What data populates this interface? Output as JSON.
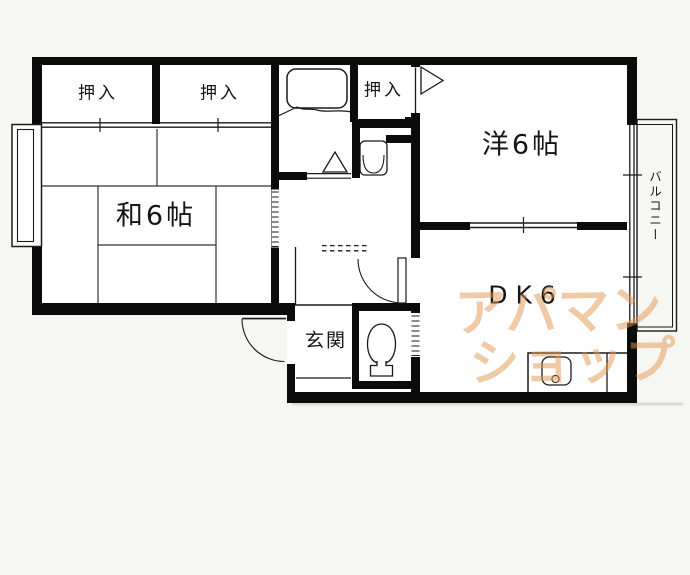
{
  "plan": {
    "title": "2DK apartment floor plan",
    "rooms": {
      "oshiire1": "押入",
      "oshiire2": "押入",
      "oshiire3": "押入",
      "washitsu": "和6帖",
      "youshitsu": "洋6帖",
      "dk": "DK6",
      "genkan": "玄関",
      "balcony": "バルコニー"
    },
    "fixtures": {
      "bathtub": "bathtub-icon",
      "washbasin": "washbasin-icon",
      "toilet": "toilet-icon",
      "kitchen_sink": "kitchen-sink-icon",
      "entrance_door": "door-swing-arc",
      "dk_door": "door-swing-arc",
      "bathroom_door_marker": "triangle-door-marker",
      "youshitsu_door_marker": "triangle-door-marker"
    },
    "watermark": {
      "line1": "アパマン",
      "line2": "ショップ",
      "color": "#e29650"
    },
    "colors": {
      "background": "#f6f6f2",
      "room_floor": "#ffffff",
      "wall": "#0b0b0b",
      "thin_line": "#1a1a1a",
      "tatami_line": "#333333",
      "shadow": "#dcdad2"
    }
  }
}
